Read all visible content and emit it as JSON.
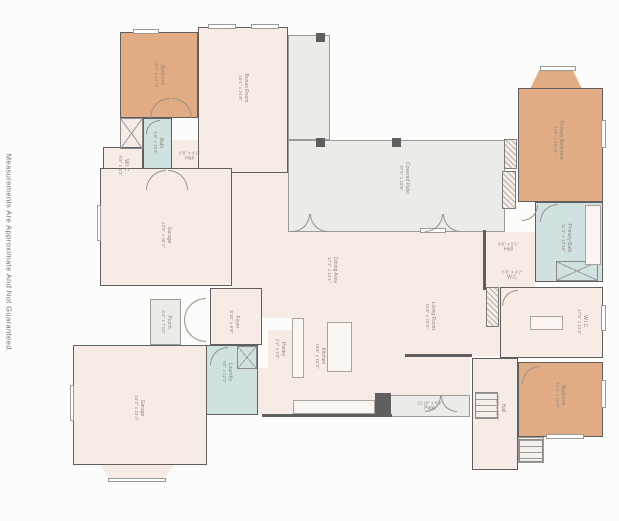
{
  "disclaimer": "Measurements Are Approximate And Not Guaranteed.",
  "palette": {
    "wall": "#5f5f5f",
    "cream": "#f7ece5",
    "tan": "#e1ac83",
    "blue": "#cfe1e0",
    "gray": "#ebebe8",
    "label": "#8f867d",
    "background": "#fcfcfa"
  },
  "rooms": [
    {
      "id": "corridor",
      "x": 232,
      "y": 173,
      "w": 56,
      "h": 115,
      "fill": "cream",
      "label": "none",
      "open": true
    },
    {
      "id": "mud-area",
      "x": 258,
      "y": 368,
      "w": 34,
      "h": 47,
      "fill": "cream",
      "label": "none",
      "open": true
    },
    {
      "id": "breakfast-nook",
      "x": 390,
      "y": 318,
      "w": 80,
      "h": 77,
      "fill": "cream",
      "label": "none",
      "open": true
    },
    {
      "id": "dining-area",
      "name": "Dining Area",
      "dims": "17'2\" x 13'1\"",
      "x": 262,
      "y": 230,
      "w": 153,
      "h": 88,
      "fill": "cream",
      "label": "v",
      "open": true,
      "lx": 332,
      "ly": 270
    },
    {
      "id": "kitchen",
      "name": "Kitchen",
      "dims": "19'8\" x 15'2\"",
      "x": 292,
      "y": 318,
      "w": 98,
      "h": 99,
      "fill": "cream",
      "label": "v",
      "open": true,
      "lx": 320,
      "ly": 356
    },
    {
      "id": "living-room",
      "name": "Living Room",
      "dims": "14'8\" x 22'6\"",
      "x": 415,
      "y": 232,
      "w": 85,
      "h": 124,
      "fill": "cream",
      "label": "v",
      "open": true,
      "lx": 430,
      "ly": 316
    },
    {
      "id": "hall-primary",
      "name": "Hall",
      "dims": "8'6\" x 5'1\"",
      "x": 482,
      "y": 232,
      "w": 53,
      "h": 30,
      "fill": "cream",
      "label": "h",
      "df": true,
      "open": true
    },
    {
      "id": "wc",
      "name": "W.C.",
      "dims": "5'0\" x 4'2\"",
      "x": 490,
      "y": 262,
      "w": 45,
      "h": 25,
      "fill": "cream",
      "label": "h",
      "df": true,
      "open": true
    },
    {
      "id": "hall-upper",
      "name": "Hall",
      "dims": "6'8\" x 4'1\"",
      "x": 172,
      "y": 140,
      "w": 35,
      "h": 44,
      "fill": "cream",
      "label": "h",
      "df": true,
      "open": true,
      "ly": 156
    },
    {
      "id": "pantry",
      "name": "Pantry",
      "dims": "4'2\" x 6'6\"",
      "x": 268,
      "y": 330,
      "w": 24,
      "h": 38,
      "fill": "cream",
      "label": "v",
      "open": true
    },
    {
      "id": "covered-patio-wing",
      "x": 288,
      "y": 35,
      "w": 42,
      "h": 105,
      "fill": "gray",
      "label": "none",
      "thin": true
    },
    {
      "id": "covered-patio",
      "name": "Covered Patio",
      "dims": "37'6\" x 15'8\"",
      "x": 288,
      "y": 140,
      "w": 217,
      "h": 92,
      "fill": "gray",
      "label": "v",
      "thin": true,
      "lx": 404,
      "ly": 178
    },
    {
      "id": "patio",
      "name": "Patio",
      "dims": "21'10\" x 6'2\"",
      "x": 390,
      "y": 395,
      "w": 80,
      "h": 22,
      "fill": "gray",
      "label": "h",
      "df": true,
      "thin": true
    },
    {
      "id": "porch",
      "name": "Porch",
      "dims": "5'4\" x 7'10\"",
      "x": 150,
      "y": 299,
      "w": 31,
      "h": 46,
      "fill": "gray",
      "label": "v",
      "thin": true
    },
    {
      "id": "stoop",
      "x": 518,
      "y": 437,
      "w": 26,
      "h": 26,
      "fill": "cream",
      "label": "none",
      "thin": true
    },
    {
      "id": "primary-bedroom-bay",
      "x": 530,
      "y": 70,
      "w": 52,
      "h": 19,
      "fill": "tan",
      "label": "none",
      "open": true,
      "clip": "bay-up"
    },
    {
      "id": "garage-lower-bay",
      "x": 98,
      "y": 463,
      "w": 78,
      "h": 18,
      "fill": "cream",
      "label": "none",
      "open": true,
      "clip": "bay-down"
    },
    {
      "id": "bedroom-2",
      "name": "Bedroom",
      "dims": "13'4\" x 14'10\"",
      "x": 120,
      "y": 32,
      "w": 78,
      "h": 86,
      "fill": "tan",
      "label": "v"
    },
    {
      "id": "bonus-room",
      "name": "Bonus Room",
      "dims": "15'4\" x 24'8\"",
      "x": 198,
      "y": 27,
      "w": 90,
      "h": 146,
      "fill": "cream",
      "label": "v",
      "lx": 243,
      "ly": 88
    },
    {
      "id": "closet-2",
      "x": 120,
      "y": 118,
      "w": 23,
      "h": 31,
      "fill": "cream",
      "label": "none"
    },
    {
      "id": "bath-2",
      "name": "Bath",
      "dims": "5'0\" x 10'6\"",
      "x": 143,
      "y": 118,
      "w": 29,
      "h": 62,
      "fill": "blue",
      "label": "v",
      "ly": 143
    },
    {
      "id": "wic-2",
      "name": "W.I.C.",
      "dims": "6'8\" x 6'2\"",
      "x": 103,
      "y": 147,
      "w": 40,
      "h": 37,
      "fill": "cream",
      "label": "v"
    },
    {
      "id": "garage-upper",
      "name": "Garage",
      "dims": "22'8\" x 20'4\"",
      "x": 100,
      "y": 168,
      "w": 132,
      "h": 118,
      "fill": "cream",
      "label": "v",
      "lx": 166,
      "ly": 235
    },
    {
      "id": "foyer",
      "name": "Foyer",
      "dims": "8'10\" x 9'8\"",
      "x": 210,
      "y": 288,
      "w": 52,
      "h": 57,
      "fill": "cream",
      "label": "v",
      "lx": 234,
      "ly": 322
    },
    {
      "id": "laundry",
      "name": "Laundry",
      "dims": "9'0\" x 12'2\"",
      "x": 205,
      "y": 345,
      "w": 53,
      "h": 70,
      "fill": "blue",
      "label": "v",
      "lx": 227,
      "ly": 372
    },
    {
      "id": "primary-bedroom",
      "name": "Primary Bedroom",
      "dims": "14'8\" x 19'10\"",
      "x": 518,
      "y": 88,
      "w": 85,
      "h": 114,
      "fill": "tan",
      "label": "v",
      "lx": 558,
      "ly": 140
    },
    {
      "id": "primary-bath",
      "name": "Primary Bath",
      "dims": "11'4\" x 13'10\"",
      "x": 535,
      "y": 202,
      "w": 68,
      "h": 80,
      "fill": "blue",
      "label": "v",
      "lx": 566,
      "ly": 238
    },
    {
      "id": "wic-primary",
      "name": "W.I.C.",
      "dims": "17'6\" x 12'4\"",
      "x": 500,
      "y": 287,
      "w": 103,
      "h": 71,
      "fill": "cream",
      "label": "v",
      "lx": 582,
      "ly": 322
    },
    {
      "id": "hall-stairs",
      "name": "Hall",
      "dims": "7'10\" x 19'2\"",
      "x": 472,
      "y": 358,
      "w": 46,
      "h": 112,
      "fill": "cream",
      "label": "v",
      "lx": 500,
      "ly": 408
    },
    {
      "id": "bedroom-3",
      "name": "Bedroom",
      "dims": "14'6\" x 12'8\"",
      "x": 518,
      "y": 362,
      "w": 85,
      "h": 75,
      "fill": "tan",
      "label": "v",
      "lx": 560,
      "ly": 395
    },
    {
      "id": "garage-lower",
      "name": "Garage",
      "dims": "23'2\" x 23'4\"",
      "x": 73,
      "y": 345,
      "w": 134,
      "h": 120,
      "fill": "cream",
      "label": "v",
      "lx": 139,
      "ly": 408
    }
  ],
  "fixtures": {
    "columns": [
      [
        316,
        33
      ],
      [
        316,
        138
      ],
      [
        392,
        138
      ]
    ],
    "blocks": [
      [
        375,
        393,
        16,
        24
      ]
    ],
    "walls": [
      [
        262,
        414,
        130,
        3
      ],
      [
        405,
        354,
        67,
        3
      ],
      [
        483,
        230,
        3,
        60
      ]
    ],
    "hatches": [
      [
        504,
        139,
        13,
        30
      ],
      [
        502,
        171,
        14,
        38
      ],
      [
        486,
        287,
        13,
        40
      ]
    ],
    "xboxes": [
      [
        120,
        118,
        23,
        31
      ],
      [
        237,
        346,
        20,
        23
      ],
      [
        556,
        261,
        42,
        20
      ]
    ],
    "stairs": [
      [
        475,
        392,
        23,
        27
      ],
      [
        519,
        439,
        24,
        23
      ]
    ],
    "islands": [
      [
        327,
        322,
        25,
        50
      ],
      [
        530,
        316,
        33,
        14
      ],
      [
        293,
        400,
        82,
        14
      ],
      [
        292,
        318,
        12,
        60
      ],
      [
        585,
        205,
        16,
        60
      ]
    ],
    "windows": [
      [
        133,
        29,
        26,
        5
      ],
      [
        208,
        24,
        28,
        5
      ],
      [
        251,
        24,
        28,
        5
      ],
      [
        540,
        66,
        36,
        5
      ],
      [
        601,
        120,
        5,
        28
      ],
      [
        601,
        305,
        5,
        26
      ],
      [
        601,
        380,
        5,
        28
      ],
      [
        546,
        434,
        38,
        5
      ],
      [
        108,
        478,
        58,
        4
      ],
      [
        70,
        385,
        4,
        36
      ],
      [
        97,
        205,
        4,
        36
      ],
      [
        420,
        228,
        26,
        5
      ]
    ],
    "arcs": [
      {
        "x": 150,
        "y": 98,
        "s": 20,
        "rot": 0
      },
      {
        "x": 172,
        "y": 98,
        "s": 20,
        "rot": 90
      },
      {
        "x": 146,
        "y": 170,
        "s": 20,
        "rot": 0
      },
      {
        "x": 168,
        "y": 170,
        "s": 20,
        "rot": 90
      },
      {
        "x": 184,
        "y": 298,
        "s": 22,
        "rot": 0
      },
      {
        "x": 184,
        "y": 320,
        "s": 22,
        "rot": 270
      },
      {
        "x": 210,
        "y": 347,
        "s": 18,
        "rot": 0
      },
      {
        "x": 292,
        "y": 214,
        "s": 18,
        "rot": 180
      },
      {
        "x": 310,
        "y": 214,
        "s": 18,
        "rot": 270
      },
      {
        "x": 425,
        "y": 214,
        "s": 18,
        "rot": 180
      },
      {
        "x": 443,
        "y": 214,
        "s": 18,
        "rot": 270
      },
      {
        "x": 540,
        "y": 204,
        "s": 18,
        "rot": 0
      },
      {
        "x": 522,
        "y": 205,
        "s": 16,
        "rot": 180
      },
      {
        "x": 522,
        "y": 366,
        "s": 18,
        "rot": 0
      },
      {
        "x": 425,
        "y": 396,
        "s": 16,
        "rot": 180
      },
      {
        "x": 441,
        "y": 396,
        "s": 16,
        "rot": 270
      },
      {
        "x": 502,
        "y": 290,
        "s": 16,
        "rot": 0
      },
      {
        "x": 146,
        "y": 120,
        "s": 14,
        "rot": 0
      }
    ]
  }
}
